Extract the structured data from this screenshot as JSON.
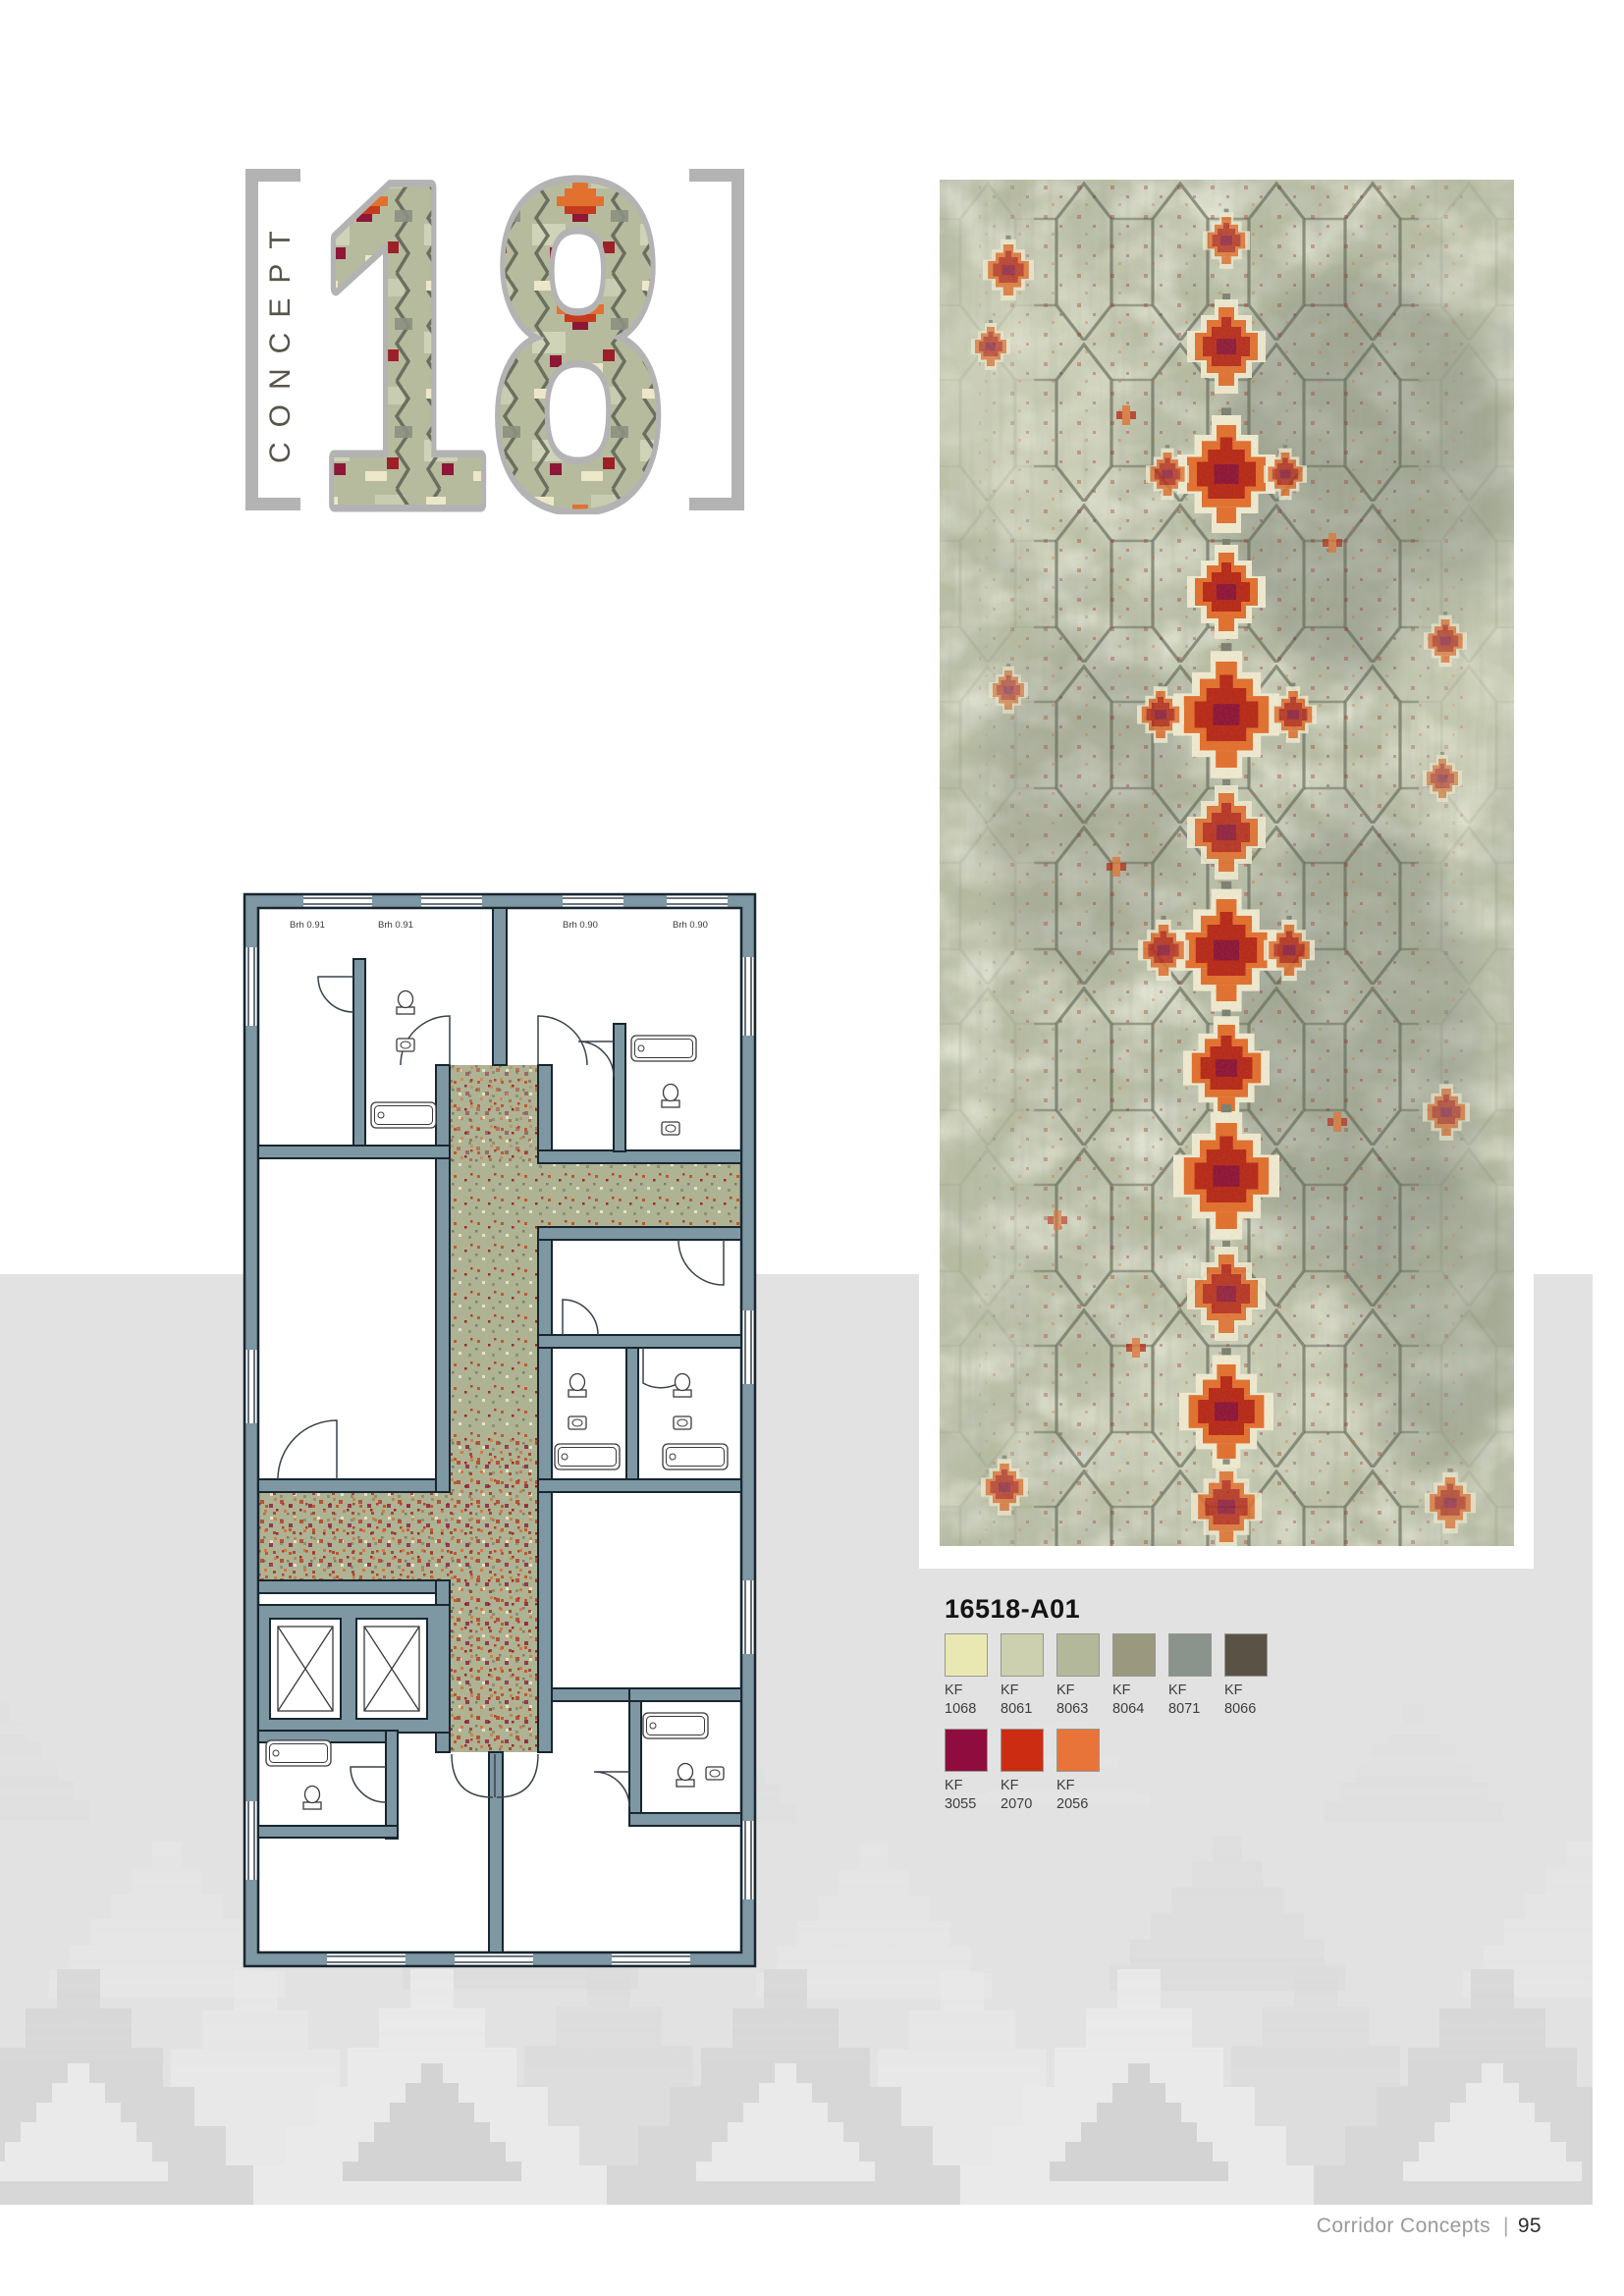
{
  "header": {
    "concept_label": "CONCEPT",
    "concept_number": "18"
  },
  "product": {
    "code": "16518-A01"
  },
  "swatches": {
    "items": [
      {
        "line1": "KF",
        "line2": "1068",
        "color": "#eae8b2"
      },
      {
        "line1": "KF",
        "line2": "8061",
        "color": "#cdd0ae"
      },
      {
        "line1": "KF",
        "line2": "8063",
        "color": "#b4b89b"
      },
      {
        "line1": "KF",
        "line2": "8064",
        "color": "#9a9980"
      },
      {
        "line1": "KF",
        "line2": "8071",
        "color": "#8a938c"
      },
      {
        "line1": "KF",
        "line2": "8066",
        "color": "#595245"
      },
      {
        "line1": "KF",
        "line2": "3055",
        "color": "#8e0d3e"
      },
      {
        "line1": "KF",
        "line2": "2070",
        "color": "#cc2c12"
      },
      {
        "line1": "KF",
        "line2": "2056",
        "color": "#e8743a"
      }
    ]
  },
  "floor_plan": {
    "room_labels": [
      "Brh 0.91",
      "Brh 0.91",
      "Brh 0.90",
      "Brh 0.90"
    ]
  },
  "footer": {
    "section": "Corridor Concepts",
    "separator": "|",
    "page_number": "95"
  },
  "colors": {
    "page_bg": "#ffffff",
    "band_bg": "#e2e2e2",
    "bracket_grey": "#b3b3b3",
    "concept_text": "#57544a",
    "carpet_base": "#b7bca1",
    "plan_wall": "#7d97a3",
    "accent_orange": "#e8743a",
    "accent_red": "#cc2c12",
    "accent_burgundy": "#8e0d3e"
  }
}
